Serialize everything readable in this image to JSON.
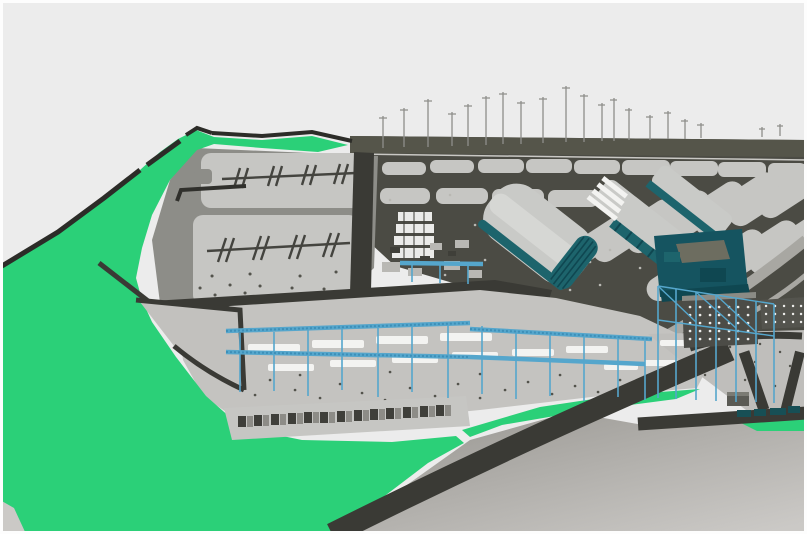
{
  "viewport": {
    "width": 807,
    "height": 534,
    "scene_label": "3D aerial view of industrial plant construction site"
  },
  "palette": {
    "sky": "#ececec",
    "frame_white": "#fdfdfd",
    "green": "#2bd078",
    "ground_dark": "#4b4b44",
    "horizon_dark": "#55554a",
    "horizon_line": "#c9c8c4",
    "pad_light": "#c6c6c3",
    "base_gray": "#8d8d88",
    "light_road": "#a8a7a2",
    "platform_light": "#c4c3c0",
    "platform_mid": "#bfbebb",
    "terrace": "#c2c1be",
    "road_dark": "#3a3a35",
    "boundary_dark": "#2c2c28",
    "hatch_dark": "#44443f",
    "mark_dark": "#30302c",
    "speckle_dark": "#53534c",
    "speckle_light": "#b9b8b3",
    "slab_white": "#f3f3f1",
    "container_dark": "#3f3f3a",
    "container_light": "#8d8c87",
    "roof_light": "#c9cac7",
    "roof_highlight": "#d6d7d4",
    "teal_dark": "#155460",
    "teal_mid": "#1d646c",
    "teal_deep": "#0f4751",
    "olive_roof": "#6d6d60",
    "facade_dark": "#4c4c47",
    "facade_dark2": "#54544e",
    "facade_strip": "#8b8b85",
    "window_white": "#ececea",
    "tower_white": "#ebebe9",
    "clutter_light": "#b9b8b4",
    "clutter_dark": "#3f3f39",
    "pipe_blue": "#55a6cc",
    "pipe_blue_dark": "#3d8fb8",
    "crane_gray": "#8e8e8a",
    "waterfront_teal": "#174f55",
    "box_dark": "#5b5b55",
    "box_top": "#7b7b74",
    "foreshore_dark": "#96948f",
    "foreshore_light": "#cbc9c6"
  },
  "scene": {
    "terrain": "bright green landscaped ground",
    "platforms": "gray terraced site platforms with foundation pads",
    "pad_marks": "foundation pads with tick hatch marks",
    "tank_farm": "dark field with rows of slanted light pads",
    "buildings": [
      "arched warehouse with teal gable end",
      "long workshop with teal side wall",
      "long workshop with white floor slabs",
      "dark teal powerhouse block with olive roof",
      "dark facade building with window dot grid",
      "small dark facade building with window dot grid"
    ],
    "structures": [
      "blue pipe-rack scaffolding",
      "tower cranes on horizon",
      "white deck slabs",
      "container laydown row",
      "white construction tower"
    ],
    "roads": "dark asphalt site roads and coastal road",
    "foreshore": "graded gray foreshore slope"
  }
}
